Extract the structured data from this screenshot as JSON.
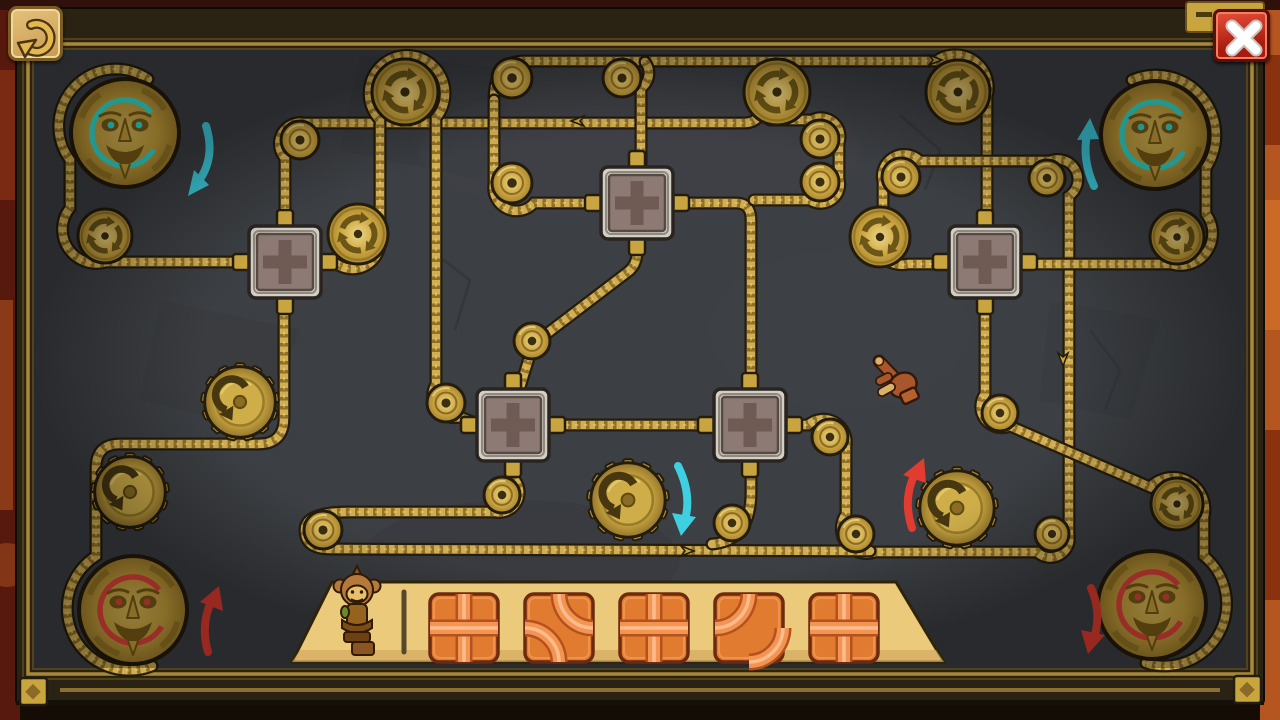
{
  "meta": {
    "app": "rope-pulley-tile-puzzle",
    "board_bg": "#3c3f43",
    "rope_gold": "#d2ae52",
    "rope_dark": "#241c0d",
    "rope_twist": "#8f7026",
    "rope_sheen": "#ecd47f",
    "gold_disc": "#c9a53f",
    "frame_gold": "#a8893a",
    "cyan": "#3ecfe0",
    "red": "#e23c30"
  },
  "window": {
    "undo_button": {
      "icon": "undo-rotate-left-icon"
    },
    "close_button": {
      "icon": "close-x-icon"
    },
    "plaque": {
      "icon": "banner-plaque-icon"
    }
  },
  "board": {
    "ropes": [
      "M 148,79 A 57,57 0 0 0 70,160 L 70,208 A 34,34 0 0 0 106,262 L 250,262",
      "M 285,226 L 285,158 A 21,21 0 0 1 304,123 L 744,123 Q 757,123 762,111",
      "M 494,100 Q 494,61 524,61 L 936,61 A 33,33 0 0 1 987,97 L 987,228",
      "M 600,203 L 534,203 A 23,23 0 0 1 494,184 L 494,100",
      "M 645,62 A 18,18 0 0 1 641,88 L 641,170",
      "M 674,203 L 736,203 Q 751,203 751,220 L 751,400",
      "M 754,200 L 810,200 A 19,19 0 0 0 839,179 L 839,143 A 19,19 0 0 0 812,120 L 770,120",
      "M 637,239 L 637,252 Q 637,264 629,271 L 549,332 Q 534,343 530,355 L 517,397",
      "M 322,262 L 334,262 A 28,28 0 0 0 380,236 L 380,120 A 38,38 0 1 1 436,118 L 436,384 A 22,22 0 0 0 460,417 L 478,424",
      "M 550,425 L 712,425",
      "M 788,425 L 808,425 A 23,23 0 0 1 846,446 L 846,514 A 25,25 0 0 0 875,552 L 1037,552 A 19,19 0 0 0 1069,535 L 1069,196 A 20,20 0 0 0 1050,161 L 920,161 A 22,22 0 0 0 883,182 L 883,216 A 28,28 0 0 0 908,264 L 948,264",
      "M 985,300 L 985,394 A 21,21 0 0 0 1010,426 L 1150,487 A 32,32 0 0 1 1204,517 L 1204,556 A 62,62 0 0 1 1146,663",
      "M 1132,80 A 60,60 0 0 1 1206,168 L 1206,214 A 32,32 0 0 1 1171,264 L 1022,264",
      "M 284,298 L 284,418 Q 284,444 258,444 L 120,444 Q 96,444 96,468 L 96,556 A 62,62 0 0 0 152,666",
      "M 513,450 L 513,478 A 20,20 0 0 1 495,512 L 348,512 Q 305,512 305,530 Q 305,549 330,549 L 870,551",
      "M 751,450 L 751,492 Q 751,541 712,544"
    ],
    "chevrons": [
      [
        575,
        121,
        180
      ],
      [
        938,
        60,
        0
      ],
      [
        1063,
        362,
        90
      ],
      [
        690,
        551,
        0
      ]
    ],
    "plain_pulleys": [
      [
        300,
        140,
        19
      ],
      [
        512,
        78,
        20
      ],
      [
        622,
        78,
        19
      ],
      [
        512,
        183,
        20
      ],
      [
        820,
        139,
        19
      ],
      [
        820,
        182,
        19
      ],
      [
        901,
        177,
        19
      ],
      [
        1047,
        178,
        18
      ],
      [
        532,
        341,
        18
      ],
      [
        446,
        403,
        19
      ],
      [
        502,
        495,
        18
      ],
      [
        323,
        530,
        19
      ],
      [
        830,
        437,
        18
      ],
      [
        732,
        523,
        18
      ],
      [
        856,
        534,
        18
      ],
      [
        1052,
        534,
        17
      ],
      [
        1000,
        413,
        18
      ]
    ],
    "arrow_pulleys": [
      [
        405,
        92,
        33
      ],
      [
        777,
        92,
        33
      ],
      [
        958,
        92,
        32
      ],
      [
        358,
        234,
        30
      ],
      [
        105,
        236,
        27
      ],
      [
        880,
        237,
        30
      ],
      [
        1177,
        237,
        27
      ],
      [
        1177,
        504,
        26
      ]
    ],
    "gears": [
      [
        240,
        402,
        38
      ],
      [
        130,
        492,
        38
      ],
      [
        628,
        500,
        40
      ],
      [
        957,
        508,
        40
      ]
    ],
    "masks": [
      {
        "x": 125,
        "y": 133,
        "r": 54,
        "ring": "#35e0d0"
      },
      {
        "x": 1155,
        "y": 135,
        "r": 54,
        "ring": "#35e0d0"
      },
      {
        "x": 133,
        "y": 610,
        "r": 54,
        "ring": "#e3453a"
      },
      {
        "x": 1152,
        "y": 605,
        "r": 54,
        "ring": "#e3453a"
      }
    ],
    "slots": [
      [
        285,
        262
      ],
      [
        637,
        203
      ],
      [
        513,
        425
      ],
      [
        750,
        425
      ],
      [
        985,
        262
      ]
    ],
    "direction_arrows": [
      {
        "path": "M 206,126 Q 216,158 198,182",
        "head": [
          [
            188,
            196
          ],
          [
            209,
            185
          ],
          [
            194,
            170
          ]
        ],
        "color": "#3ecfe0",
        "dir": "down"
      },
      {
        "path": "M 1094,186 Q 1082,160 1087,134",
        "head": [
          [
            1090,
            118
          ],
          [
            1077,
            140
          ],
          [
            1099,
            139
          ]
        ],
        "color": "#3ecfe0",
        "dir": "up"
      },
      {
        "path": "M 678,466 Q 692,494 685,520",
        "head": [
          [
            681,
            536
          ],
          [
            672,
            513
          ],
          [
            696,
            517
          ]
        ],
        "color": "#3ecfe0",
        "dir": "down"
      },
      {
        "path": "M 912,528 Q 902,498 916,472",
        "head": [
          [
            924,
            458
          ],
          [
            903,
            475
          ],
          [
            926,
            483
          ]
        ],
        "color": "#e23c30",
        "dir": "up"
      },
      {
        "path": "M 208,652 Q 200,624 212,600",
        "head": [
          [
            219,
            586
          ],
          [
            200,
            602
          ],
          [
            223,
            611
          ]
        ],
        "color": "#e23c30",
        "dir": "up"
      },
      {
        "path": "M 1091,588 Q 1102,612 1094,638",
        "head": [
          [
            1088,
            654
          ],
          [
            1081,
            630
          ],
          [
            1105,
            635
          ]
        ],
        "color": "#e23c30",
        "dir": "down"
      }
    ]
  },
  "tray": {
    "shape": "332,582 896,582 944,662 292,662",
    "fill": "#ecca7c",
    "divider_x": 404,
    "tile_y": 628,
    "tile_size": 68,
    "tile_xs": [
      464,
      559,
      654,
      749,
      844
    ],
    "tiles": [
      {
        "pattern": "cross"
      },
      {
        "pattern": "curve-tr-bl"
      },
      {
        "pattern": "cross"
      },
      {
        "pattern": "curve-tl-br"
      },
      {
        "pattern": "cross"
      }
    ],
    "monkey_statue": {
      "x": 357,
      "y": 612
    }
  },
  "cursor": {
    "type": "hand-pointer",
    "x": 879,
    "y": 361
  }
}
